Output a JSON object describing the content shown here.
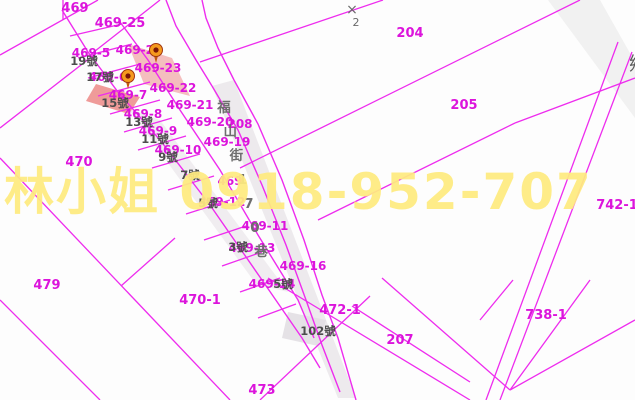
{
  "map": {
    "background": "#fdfdfd",
    "line_color": "#ee2cee",
    "parcel_label_color": "#dc14dc",
    "house_label_color": "#4d4d4d",
    "watermark": {
      "text": "林小姐 0918-952-707",
      "color": "#ffeb80"
    },
    "symbol_x2": {
      "glyph": "×",
      "sub": "2",
      "x": 352,
      "y": 14,
      "color": "#6a6a6a"
    },
    "edge_glyph": {
      "text": "鄉",
      "x": 629,
      "y": 70,
      "color": "#585858"
    },
    "street": {
      "label": "福山街170巷",
      "x": 224,
      "y": 112,
      "step_x": 6.2,
      "step_y": 24,
      "color": "#6e6e6e",
      "size": 13.5
    },
    "pins": [
      {
        "x": 156,
        "y": 50
      },
      {
        "x": 128,
        "y": 76
      }
    ],
    "pin_colors": {
      "outer": "#f59a1e",
      "inner": "#7a1507",
      "tail": "#c2590f",
      "stroke": "#a03510"
    },
    "polygons": [
      {
        "name": "road-surface-street",
        "points": "212,86 234,80 356,398 338,398",
        "fill": "#e8e5e9",
        "opacity": 0.8
      },
      {
        "name": "parcel-strip-shade",
        "points": "128,108 160,120 288,292 256,284",
        "fill": "#e9e5ea",
        "opacity": 0.7
      },
      {
        "name": "parcel-102-shade",
        "points": "288,312 326,320 318,346 282,338",
        "fill": "#e2dfe3",
        "opacity": 0.9
      },
      {
        "name": "road-band-topright",
        "points": "548,0 600,0 635,62 635,118",
        "fill": "#ededed",
        "opacity": 0.8
      },
      {
        "name": "highlight-parcel-469-23",
        "points": "128,44 172,58 190,96 144,84",
        "fill": "#f3b7b7",
        "opacity": 0.9
      },
      {
        "name": "highlight-parcel-15",
        "points": "96,84 140,97 129,114 86,101",
        "fill": "#ee9693",
        "opacity": 0.95
      }
    ],
    "lines": [
      {
        "x1": 98,
        "y1": 0,
        "x2": 0,
        "y2": 55
      },
      {
        "x1": 63,
        "y1": 0,
        "x2": 63,
        "y2": 20
      },
      {
        "x1": 0,
        "y1": 128,
        "x2": 90,
        "y2": 58
      },
      {
        "x1": 0,
        "y1": 158,
        "x2": 230,
        "y2": 400
      },
      {
        "x1": 0,
        "y1": 300,
        "x2": 100,
        "y2": 400
      },
      {
        "x1": 175,
        "y1": 238,
        "x2": 121,
        "y2": 286
      },
      {
        "x1": 90,
        "y1": 55,
        "x2": 160,
        "y2": 0
      },
      {
        "x1": 200,
        "y1": 62,
        "x2": 383,
        "y2": 0
      },
      {
        "x1": 240,
        "y1": 168,
        "x2": 580,
        "y2": 0
      },
      {
        "x1": 318,
        "y1": 220,
        "x2": 515,
        "y2": 123
      },
      {
        "x1": 515,
        "y1": 123,
        "x2": 635,
        "y2": 78
      },
      {
        "x1": 632,
        "y1": 52,
        "x2": 500,
        "y2": 400
      },
      {
        "x1": 618,
        "y1": 42,
        "x2": 486,
        "y2": 400
      },
      {
        "x1": 268,
        "y1": 278,
        "x2": 470,
        "y2": 400
      },
      {
        "x1": 370,
        "y1": 296,
        "x2": 260,
        "y2": 400
      },
      {
        "x1": 352,
        "y1": 306,
        "x2": 470,
        "y2": 382
      },
      {
        "x1": 382,
        "y1": 278,
        "x2": 510,
        "y2": 390
      },
      {
        "x1": 510,
        "y1": 390,
        "x2": 635,
        "y2": 320
      },
      {
        "x1": 480,
        "y1": 320,
        "x2": 513,
        "y2": 280
      },
      {
        "x1": 590,
        "y1": 280,
        "x2": 510,
        "y2": 390
      },
      {
        "x1": 70,
        "y1": 36,
        "x2": 122,
        "y2": 24
      },
      {
        "x1": 78,
        "y1": 58,
        "x2": 132,
        "y2": 44
      },
      {
        "x1": 88,
        "y1": 78,
        "x2": 140,
        "y2": 64
      },
      {
        "x1": 98,
        "y1": 96,
        "x2": 150,
        "y2": 82
      },
      {
        "x1": 110,
        "y1": 114,
        "x2": 160,
        "y2": 100
      },
      {
        "x1": 124,
        "y1": 132,
        "x2": 172,
        "y2": 118
      },
      {
        "x1": 138,
        "y1": 150,
        "x2": 186,
        "y2": 136
      },
      {
        "x1": 152,
        "y1": 168,
        "x2": 200,
        "y2": 154
      },
      {
        "x1": 168,
        "y1": 190,
        "x2": 214,
        "y2": 176
      },
      {
        "x1": 186,
        "y1": 214,
        "x2": 230,
        "y2": 200
      },
      {
        "x1": 204,
        "y1": 240,
        "x2": 246,
        "y2": 226
      },
      {
        "x1": 222,
        "y1": 266,
        "x2": 262,
        "y2": 252
      },
      {
        "x1": 240,
        "y1": 292,
        "x2": 280,
        "y2": 278
      },
      {
        "x1": 258,
        "y1": 318,
        "x2": 296,
        "y2": 304
      }
    ],
    "polylines": [
      {
        "name": "strip-left-boundary",
        "points": "62,10 88,52 118,92 160,140 210,205 262,280 302,338 320,368"
      },
      {
        "name": "strip-right-boundary",
        "points": "120,22 148,60 180,110 220,170 258,235 298,300 314,338"
      },
      {
        "name": "street-left-edge",
        "points": "212,86 238,130 262,185 286,245 306,300 322,345 340,392"
      },
      {
        "name": "street-right-edge",
        "points": "234,80 258,124 282,180 304,240 322,295 338,338 356,400"
      },
      {
        "name": "street-upper-left-edge",
        "points": "212,86 196,60 176,26 166,0"
      },
      {
        "name": "street-upper-right-edge",
        "points": "234,80 218,48 206,18 202,0"
      }
    ],
    "parcel_labels": [
      {
        "text": "469",
        "x": 75,
        "y": 8,
        "size": 13
      },
      {
        "text": "469-25",
        "x": 120,
        "y": 23,
        "size": 13
      },
      {
        "text": "469-5",
        "x": 91,
        "y": 53,
        "size": 12
      },
      {
        "text": "469-24",
        "x": 139,
        "y": 50,
        "size": 12
      },
      {
        "text": "469-23",
        "x": 158,
        "y": 68,
        "size": 12
      },
      {
        "text": "469-6",
        "x": 108,
        "y": 77,
        "size": 12
      },
      {
        "text": "469-7",
        "x": 128,
        "y": 95,
        "size": 12
      },
      {
        "text": "469-22",
        "x": 173,
        "y": 88,
        "size": 12
      },
      {
        "text": "469-21",
        "x": 190,
        "y": 105,
        "size": 12
      },
      {
        "text": "469-8",
        "x": 143,
        "y": 114,
        "size": 12
      },
      {
        "text": "469-20",
        "x": 210,
        "y": 122,
        "size": 12
      },
      {
        "text": "208",
        "x": 240,
        "y": 124,
        "size": 12
      },
      {
        "text": "469-9",
        "x": 158,
        "y": 131,
        "size": 12
      },
      {
        "text": "469-19",
        "x": 227,
        "y": 142,
        "size": 12
      },
      {
        "text": "469-10",
        "x": 178,
        "y": 150,
        "size": 12
      },
      {
        "text": "470",
        "x": 79,
        "y": 162,
        "size": 13
      },
      {
        "text": "469",
        "x": 230,
        "y": 181,
        "size": 12
      },
      {
        "text": "469-12",
        "x": 222,
        "y": 202,
        "size": 12
      },
      {
        "text": "469-11",
        "x": 265,
        "y": 226,
        "size": 12
      },
      {
        "text": "469-13",
        "x": 252,
        "y": 248,
        "size": 12
      },
      {
        "text": "469-16",
        "x": 303,
        "y": 266,
        "size": 12
      },
      {
        "text": "469-14",
        "x": 272,
        "y": 284,
        "size": 12
      },
      {
        "text": "479",
        "x": 47,
        "y": 285,
        "size": 13
      },
      {
        "text": "470-1",
        "x": 200,
        "y": 300,
        "size": 13
      },
      {
        "text": "472-1",
        "x": 340,
        "y": 310,
        "size": 13
      },
      {
        "text": "204",
        "x": 410,
        "y": 33,
        "size": 13
      },
      {
        "text": "205",
        "x": 464,
        "y": 105,
        "size": 13
      },
      {
        "text": "207",
        "x": 400,
        "y": 340,
        "size": 13
      },
      {
        "text": "742-1",
        "x": 617,
        "y": 205,
        "size": 13
      },
      {
        "text": "738-1",
        "x": 546,
        "y": 315,
        "size": 13
      },
      {
        "text": "473",
        "x": 262,
        "y": 390,
        "size": 13
      }
    ],
    "house_labels": [
      {
        "text": "19號",
        "x": 84,
        "y": 61
      },
      {
        "text": "17號",
        "x": 100,
        "y": 77
      },
      {
        "text": "15號",
        "x": 115,
        "y": 103
      },
      {
        "text": "13號",
        "x": 139,
        "y": 122
      },
      {
        "text": "11號",
        "x": 155,
        "y": 139
      },
      {
        "text": "9號",
        "x": 168,
        "y": 157
      },
      {
        "text": "7號",
        "x": 190,
        "y": 175
      },
      {
        "text": "5號",
        "x": 208,
        "y": 203
      },
      {
        "text": "3號",
        "x": 238,
        "y": 247
      },
      {
        "text": "5號",
        "x": 283,
        "y": 284
      },
      {
        "text": "102號",
        "x": 318,
        "y": 331
      }
    ]
  }
}
